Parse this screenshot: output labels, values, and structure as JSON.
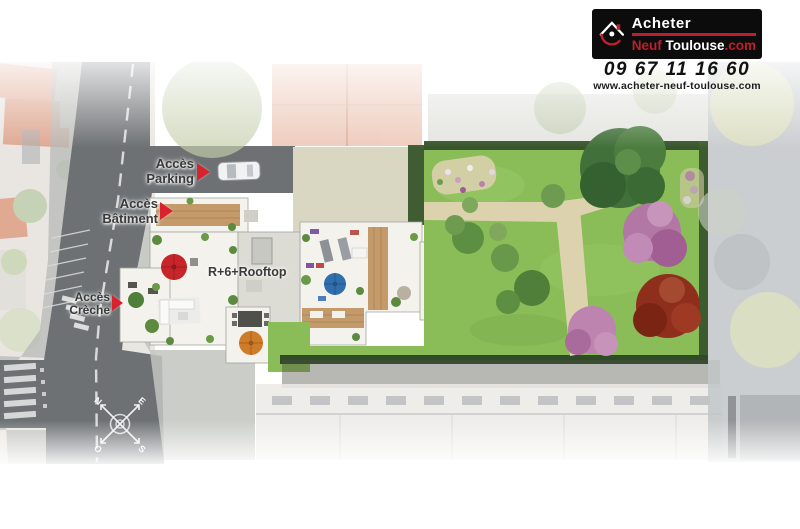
{
  "branding": {
    "logo_word1": "Acheter",
    "logo_word2": "Neuf",
    "logo_word3": "Toulouse",
    "logo_suffix": ".com",
    "phone": "09 67 11 16 60",
    "website": "www.acheter-neuf-toulouse.com"
  },
  "labels": {
    "parking": {
      "line1": "Accès",
      "line2": "Parking"
    },
    "batiment": {
      "line1": "Accès",
      "line2": "Bâtiment"
    },
    "creche": {
      "line1": "Accès",
      "line2": "Crèche"
    },
    "rooftop": "R+6+Rooftop"
  },
  "compass": {
    "north": "N",
    "east": "E",
    "south": "S",
    "west": "O"
  },
  "colors": {
    "logo_red": "#be1e2d",
    "marker_red": "#d8232e",
    "road": "#6e7174",
    "lawn": "#8abc58",
    "path": "#dcd2ae",
    "rooftop_white": "#f3f2ed",
    "wood_deck": "#c49a6b",
    "hedge": "#36532b",
    "tree_pink": "#b377a5",
    "tree_red": "#8e2e1c",
    "umbrella_red": "#c8252b",
    "umbrella_blue": "#2f6fad",
    "umbrella_orange": "#cf7c2a"
  }
}
